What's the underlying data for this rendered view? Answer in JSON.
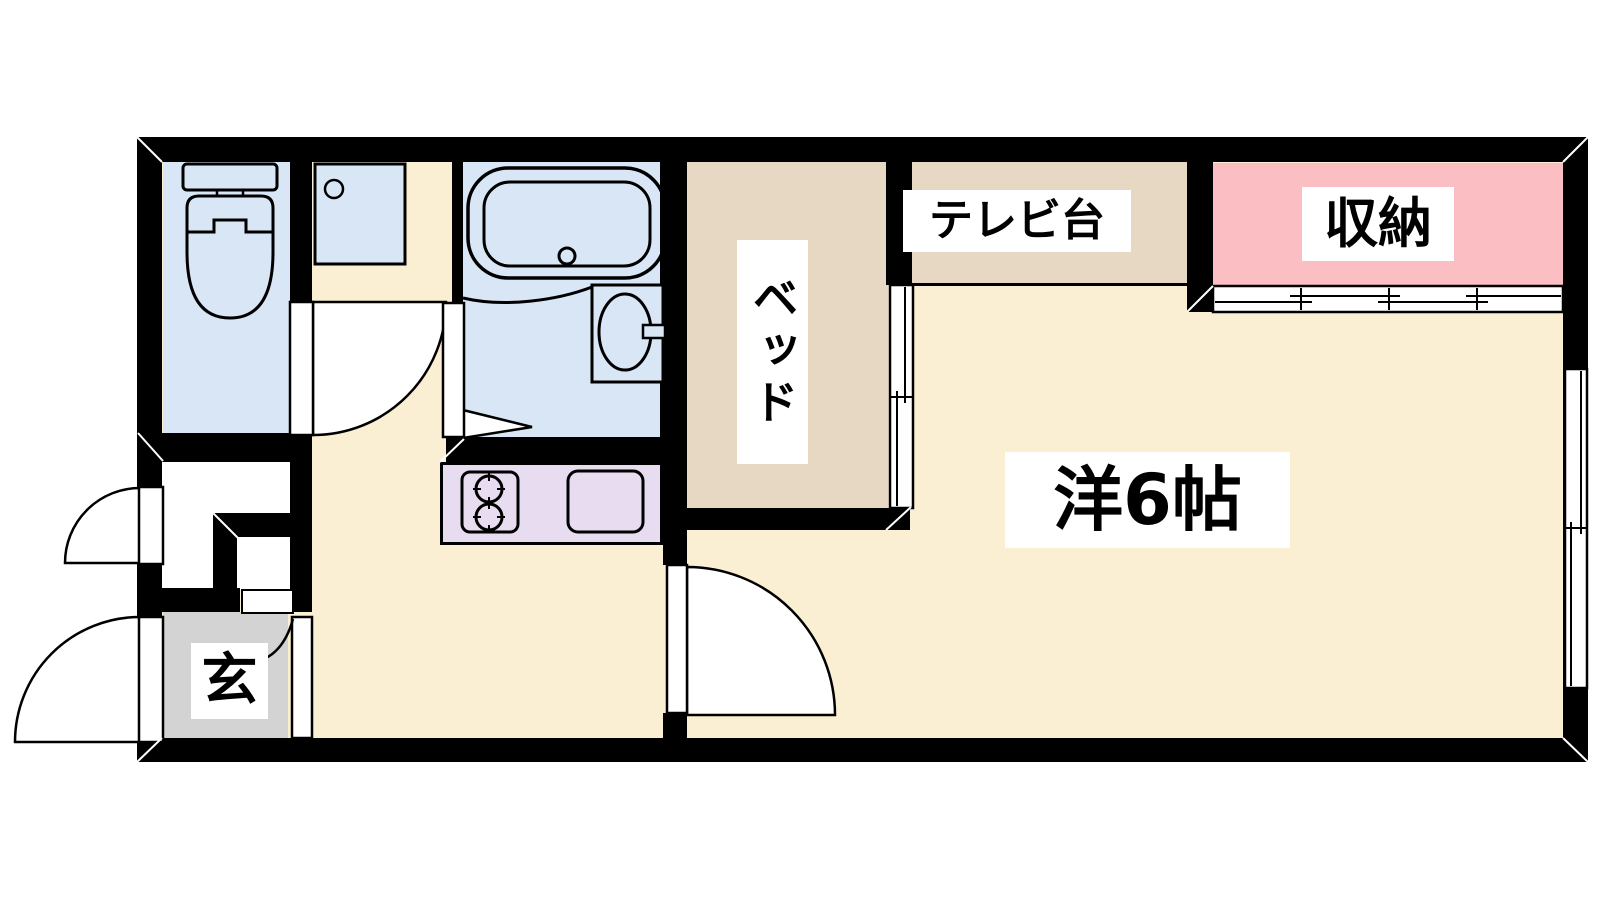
{
  "floor_plan": {
    "type": "japanese-apartment-floorplan",
    "labels": {
      "tv_stand": "テレビ台",
      "storage": "収納",
      "bed": "ベッド",
      "western_room": "洋6帖",
      "entrance": "玄"
    },
    "rooms": [
      {
        "id": "western-room",
        "label": "洋6帖",
        "color": "#FBEFD3"
      },
      {
        "id": "bed-alcove",
        "label": "ベッド",
        "color": "#E6D8C3"
      },
      {
        "id": "tv-stand",
        "label": "テレビ台",
        "color": "#E6D8C3"
      },
      {
        "id": "storage-closet",
        "label": "収納",
        "color": "#FBBFC3"
      },
      {
        "id": "entrance-genkan",
        "label": "玄",
        "color": "#D3D3D3"
      },
      {
        "id": "toilet-room",
        "label": "",
        "color": "#D8E6F6"
      },
      {
        "id": "bathroom",
        "label": "",
        "color": "#D8E6F6"
      },
      {
        "id": "washer-space",
        "label": "",
        "color": "#D8E6F6"
      },
      {
        "id": "kitchen-counter",
        "label": "",
        "color": "#E7DCF0"
      }
    ],
    "colors": {
      "wall": "#000000",
      "floor": "#FBEFD3",
      "furniture_tan": "#E6D8C3",
      "storage_pink": "#FBBFC3",
      "wet_area_blue": "#D8E6F6",
      "kitchen_lavender": "#E7DCF0",
      "genkan_grey": "#D3D3D3",
      "background": "#FFFFFF"
    }
  }
}
